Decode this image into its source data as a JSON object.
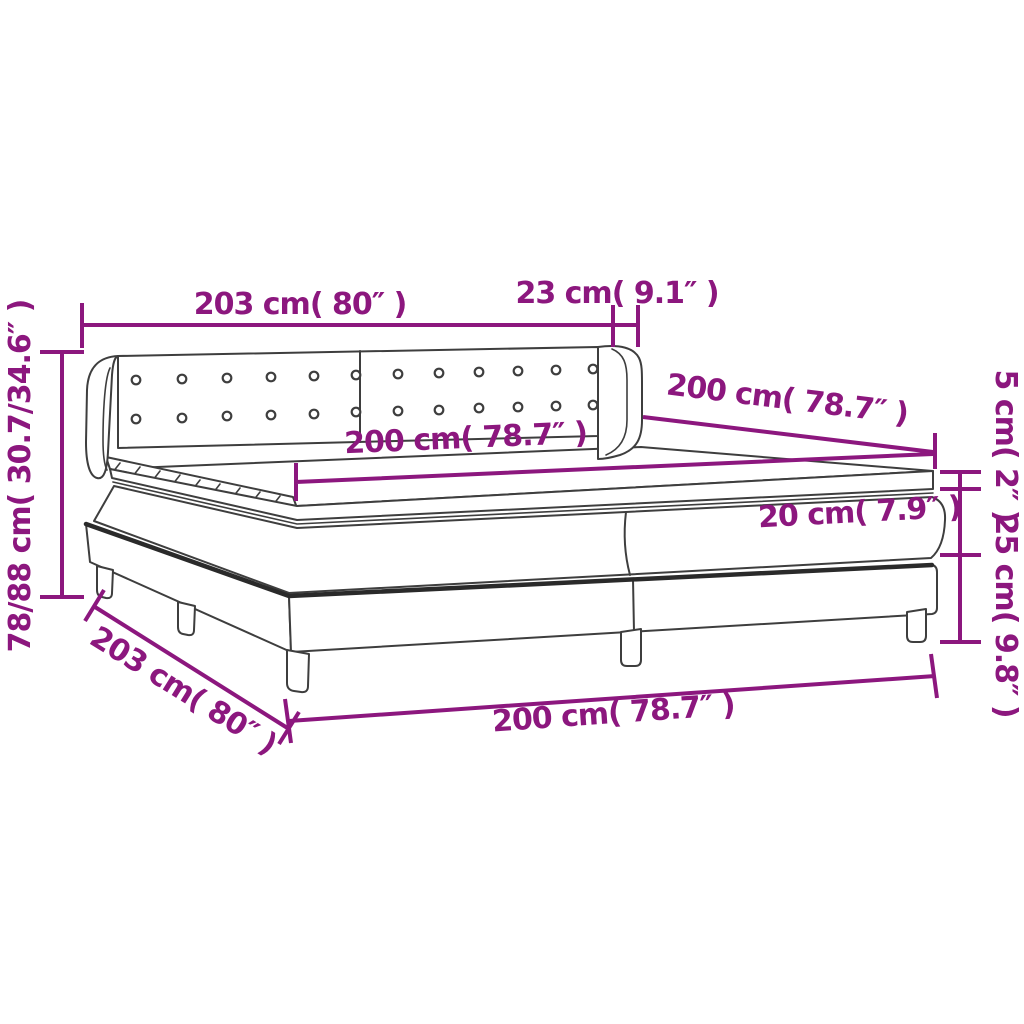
{
  "colors": {
    "accent": "#8C177E",
    "line": "#3E3E3E",
    "thick": "#2A2A2A",
    "background": "#FFFFFF"
  },
  "labels": {
    "headboard_width": "203 cm( 80″ )",
    "wing_depth": "23 cm( 9.1″ )",
    "bed_height_range": "78/88 cm( 30.7/34.6″ )",
    "length_right": "200 cm( 78.7″ )",
    "mattress_width": "200 cm( 78.7″ )",
    "topper_height": "5 cm( 2″ )",
    "mattress_height": "20 cm( 7.9″ )",
    "base_height": "25 cm( 9.8″ )",
    "base_length_diagonal": "203 cm( 80″ )",
    "bottom_width": "200 cm( 78.7″ )"
  }
}
